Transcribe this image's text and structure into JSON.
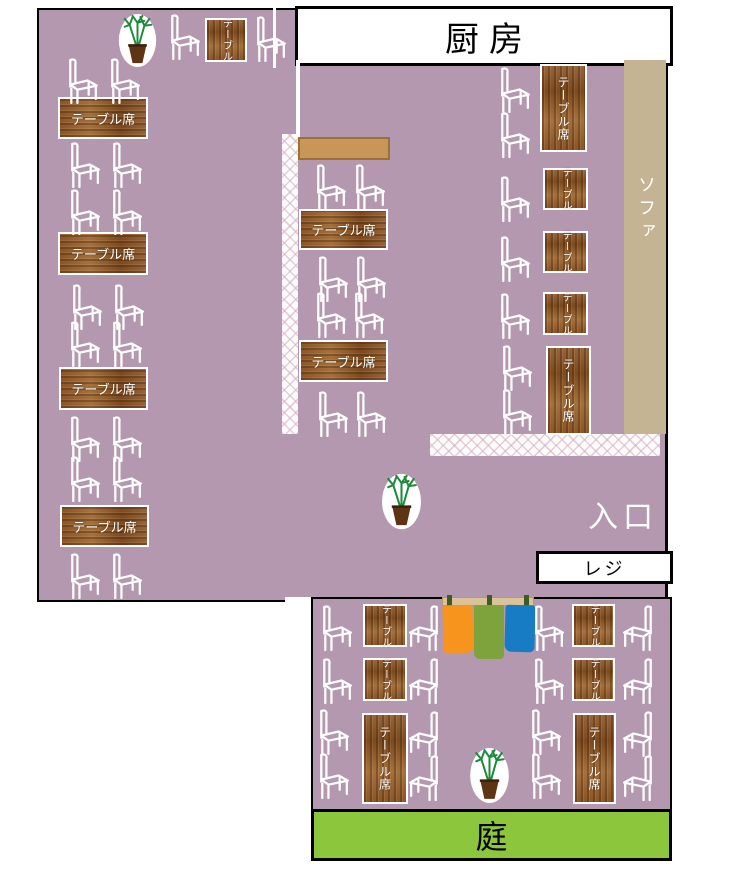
{
  "title": "restaurant-seating-floor-plan",
  "labels": {
    "kitchen": "厨房",
    "sofa": "ソファ",
    "entrance": "入口",
    "register": "レジ",
    "garden": "庭",
    "table_seat": "テーブル席",
    "table": "テーブル"
  },
  "areas": {
    "kitchen": "厨房",
    "sofa_bench": "ソファ",
    "entrance": "入口",
    "register_counter": "レジ",
    "garden": "庭",
    "dining_floor": "テーブル席",
    "small_tables": "テーブル"
  },
  "counts": {
    "large_tables_left_column": 4,
    "large_tables_middle_column": 2,
    "large_tables_right_column": 2,
    "small_tables_right_column": 3,
    "small_tables_bottom_room": 4,
    "large_tables_bottom_room": 2,
    "small_table_top": 1,
    "plants": 3
  },
  "colors": {
    "floor": "#b398af",
    "sofa": "#c5b494",
    "counter": "#c9965a",
    "garden": "#8cc63c",
    "outline": "#000000",
    "wall_white": "#ffffff",
    "wood_dark": "#7c4a1e",
    "wood_light": "#a5713d",
    "noren_orange": "#f7941e",
    "noren_green": "#7fa33c",
    "noren_blue": "#187cc5",
    "plant_green": "#1e8a3c",
    "pot_brown": "#5e3514"
  }
}
